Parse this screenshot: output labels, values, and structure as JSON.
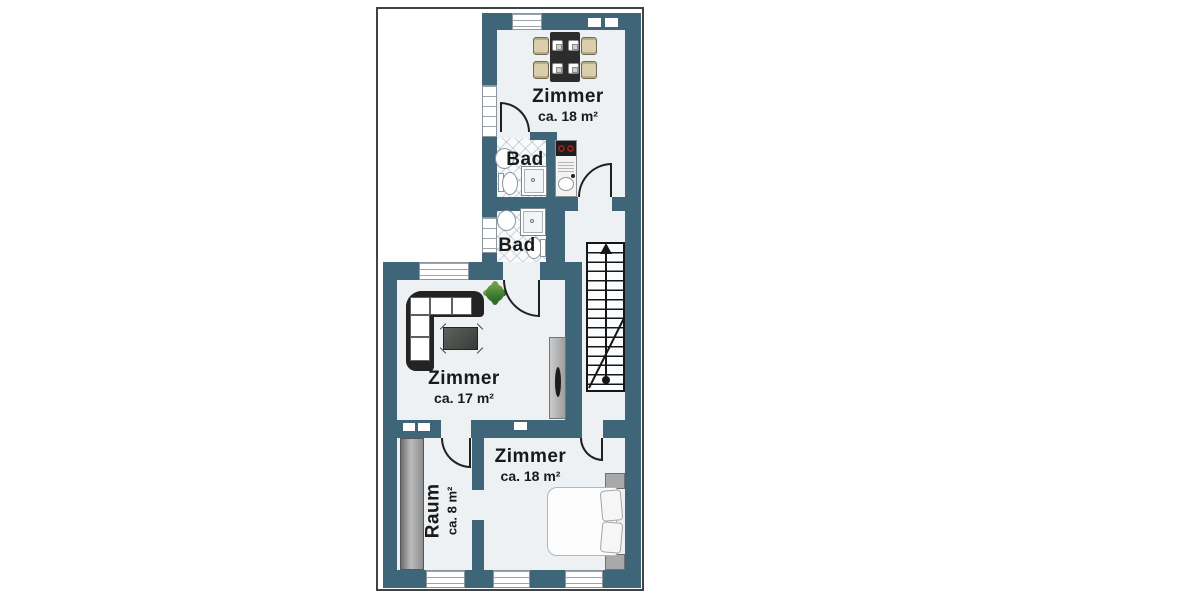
{
  "plan": {
    "type": "apartment-floorplan",
    "colors": {
      "wall": "#3f6678",
      "floor": "#edf1f4",
      "outside": "#ffffff",
      "frame_border": "#3d4347",
      "door_line": "#202020",
      "stair_line": "#161616",
      "chair_beige": "#dbcfab",
      "plant_green": "#3f7a2e"
    },
    "rooms": {
      "zimmer_top": {
        "name": "Zimmer",
        "area": "ca. 18 m²"
      },
      "bad_upper": {
        "name": "Bad"
      },
      "bad_lower": {
        "name": "Bad"
      },
      "zimmer_middle": {
        "name": "Zimmer",
        "area": "ca. 17 m²"
      },
      "raum": {
        "name": "Raum",
        "area": "ca. 8 m²"
      },
      "zimmer_bottom": {
        "name": "Zimmer",
        "area": "ca. 18 m²"
      }
    }
  }
}
